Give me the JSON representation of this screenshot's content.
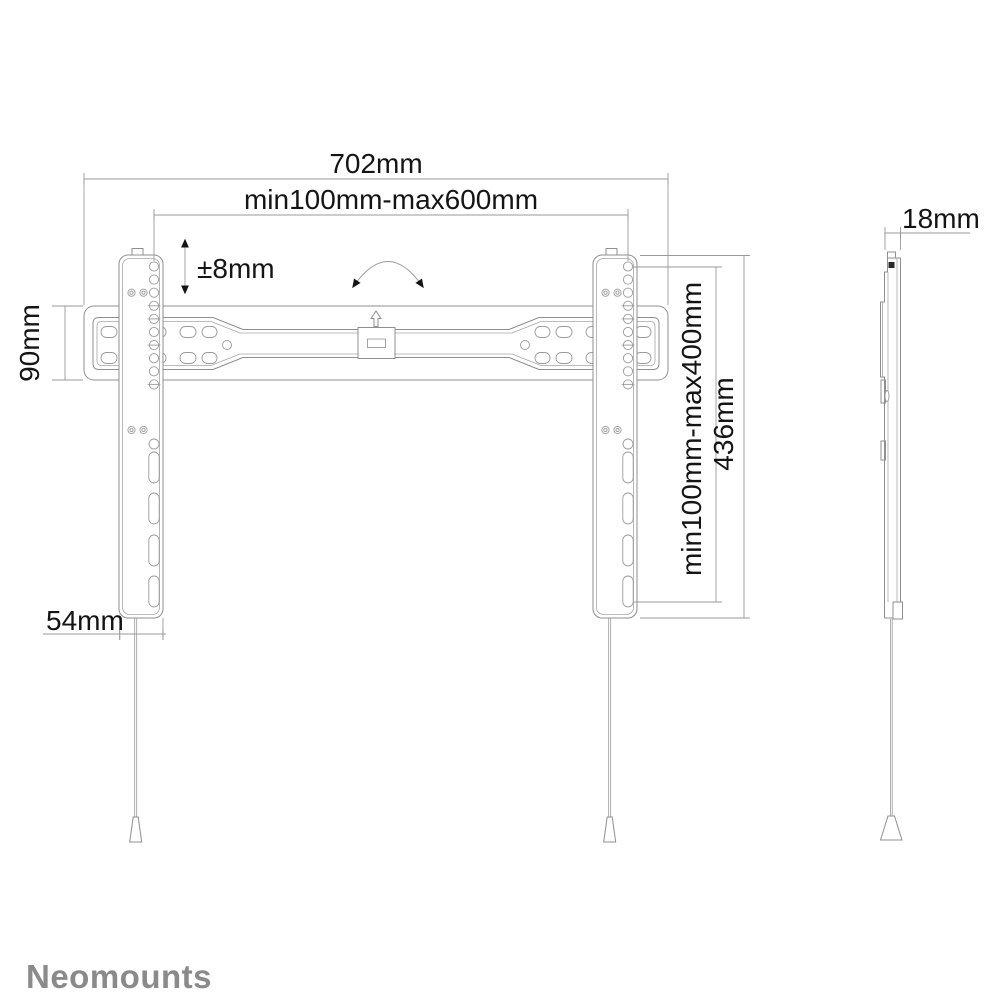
{
  "colors": {
    "background": "#ffffff",
    "part_line": "#8f8f8f",
    "dimension_line": "#9a9a9a",
    "text": "#141414",
    "logo": "#8a8a8a"
  },
  "dimensions": {
    "total_width": "702mm",
    "width_range": "min100mm-max600mm",
    "height_adjust": "±8mm",
    "plate_height": "90mm",
    "height_range": "min100mm-max400mm",
    "rail_height": "436mm",
    "rail_width": "54mm",
    "depth": "18mm"
  },
  "logo": {
    "text": "Neomounts"
  }
}
